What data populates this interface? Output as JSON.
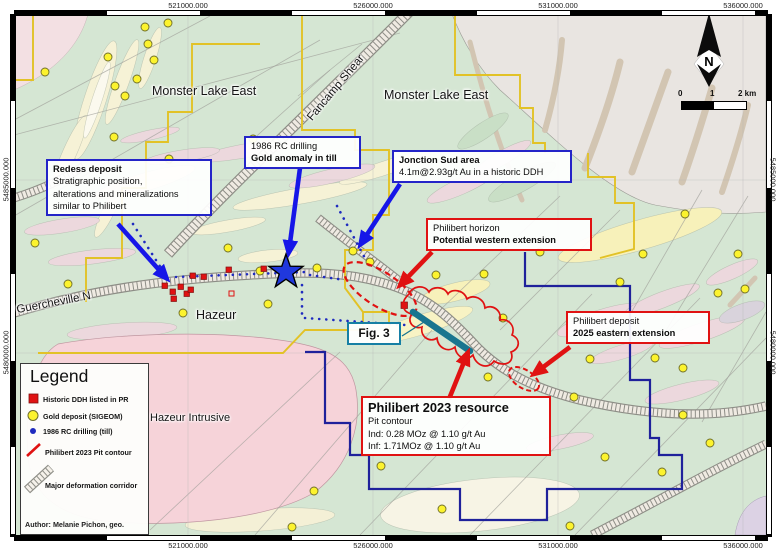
{
  "frame": {
    "top_coords": [
      "521000.000",
      "526000.000",
      "531000.000",
      "536000.000"
    ],
    "bottom_coords": [
      "521000.000",
      "526000.000",
      "531000.000",
      "536000.000"
    ],
    "left_coords": [
      "5485000.000",
      "5480000.000"
    ],
    "right_coords": [
      "5485000.000",
      "5480000.000"
    ]
  },
  "map_labels": {
    "monster_lake_east_w": "Monster Lake East",
    "monster_lake_east_e": "Monster Lake East",
    "fancamp_shear": "Fancamp Shear",
    "guercheville": "Guercheville N",
    "hazeur": "Hazeur",
    "hazeur_intrusive": "Hazeur Intrusive"
  },
  "callouts": {
    "redess": {
      "title": "Redess deposit",
      "line1": "Stratigraphic position,",
      "line2": "alterations and mineralizations",
      "line3": "similar to Philibert"
    },
    "rc_drilling": {
      "line1": "1986 RC drilling",
      "line2": "Gold anomaly in till"
    },
    "jonction_sud": {
      "title": "Jonction Sud area",
      "line1": "4.1m@2.93g/t Au in a historic DDH"
    },
    "philibert_horizon": {
      "line1": "Philibert horizon",
      "line2": "Potential western extension"
    },
    "philibert_deposit": {
      "line1": "Philibert deposit",
      "line2": "2025 eastern extension"
    },
    "philibert_resource": {
      "title": "Philibert 2023 resource",
      "line1": "Pit contour",
      "line2": "Ind: 0.28 MOz @ 1.10 g/t Au",
      "line3": "Inf: 1.71MOz @ 1.10 g/t Au"
    },
    "fig3": {
      "label": "Fig. 3"
    }
  },
  "legend": {
    "title": "Legend",
    "items": [
      {
        "label": "Historic DDH listed in PR"
      },
      {
        "label": "Gold deposit (SIGEOM)"
      },
      {
        "label": "1986 RC drilling (till)"
      },
      {
        "label": "Philibert 2023 Pit contour"
      },
      {
        "label": "Major deformation corridor"
      }
    ],
    "author": "Author: Melanie Pichon, geo."
  },
  "north_label": "N",
  "scale_bar": {
    "tick0": "0",
    "tick1": "1",
    "tick2": "2 km"
  },
  "colors": {
    "greenstone": "#d5e6d3",
    "sediment_gray": "#e9e5e1",
    "intrusive_pink": "#f6d3d9",
    "claim_yellow": "#e2c227",
    "claim_blue": "#1f219b",
    "callout_blue": "#2424c8",
    "callout_red": "#e01212",
    "fig3_teal": "#167fa4",
    "star_blue": "#2038dd",
    "gold_dot": "#fcf32e",
    "rc_dot_blue": "#1f2bbf",
    "section_teal": "#19758f"
  }
}
